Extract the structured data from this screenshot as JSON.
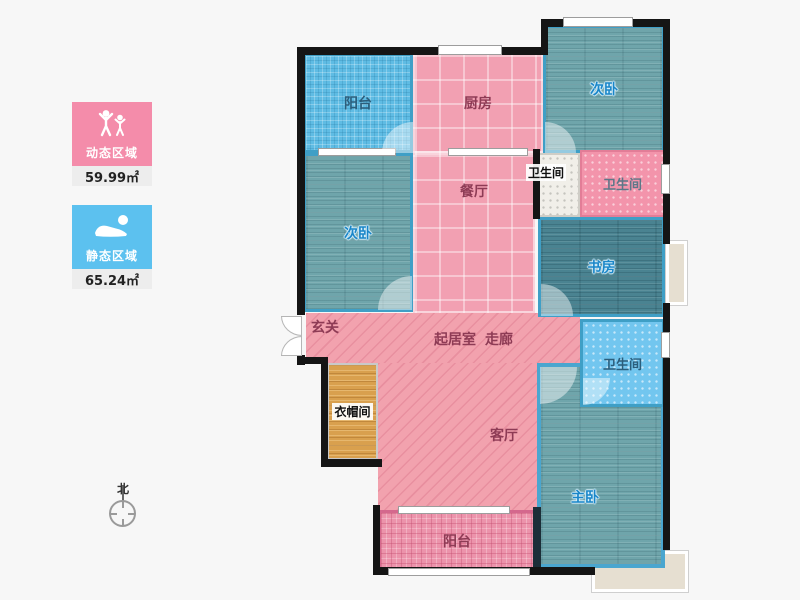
{
  "legend": {
    "dynamic": {
      "label": "动态区域",
      "area": "59.99㎡",
      "color": "#f48caa"
    },
    "static": {
      "label": "静态区域",
      "area": "65.24㎡",
      "color": "#5cc1ef"
    }
  },
  "compass": {
    "north_label": "北"
  },
  "rooms": {
    "balcony_top": {
      "label": "阳台"
    },
    "kitchen": {
      "label": "厨房"
    },
    "bedroom_top_right": {
      "label": "次卧"
    },
    "bath_white": {
      "label": "卫生间"
    },
    "bath_pink": {
      "label": "卫生间"
    },
    "bedroom_left": {
      "label": "次卧"
    },
    "dining": {
      "label": "餐厅"
    },
    "study": {
      "label": "书房"
    },
    "entry": {
      "label": "玄关"
    },
    "corridor": {
      "label_living": "起居室",
      "label_hall": "走廊"
    },
    "bath_blue": {
      "label": "卫生间"
    },
    "cloakroom": {
      "label": "衣帽间"
    },
    "living": {
      "label": "客厅"
    },
    "master": {
      "label": "主卧"
    },
    "balcony_bottom": {
      "label": "阳台"
    }
  },
  "colors": {
    "wall": "#151515",
    "pink_room": "#f2a0b2",
    "corridor_pink": "#f2a2ae",
    "blue_balcony": "#5fbce4",
    "teal_floor": "#6fa5ab",
    "study_floor": "#4a8391",
    "bath_blue": "#72c6ef",
    "bath_pink": "#f394ab",
    "bath_white": "#f1efe9",
    "cloak_orange": "#d9a04e",
    "balcony_rose": "#ec93ab",
    "bay_window": "#e6dfd1",
    "room_border_blue": "#3f9fc6",
    "label_blue": "#1a86c8",
    "label_pink": "#8e3b55"
  }
}
